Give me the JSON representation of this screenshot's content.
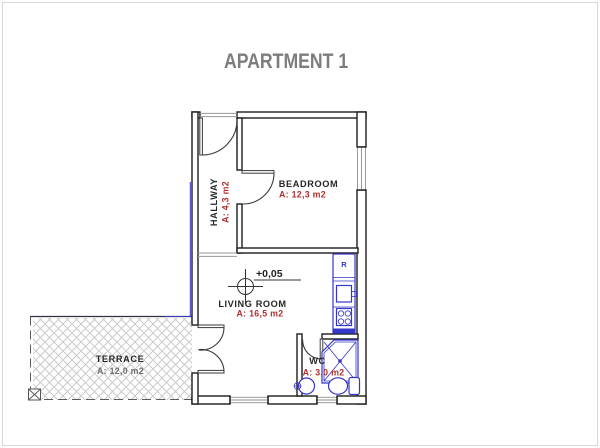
{
  "title": "APARTMENT 1",
  "plan": {
    "rooms": [
      {
        "name": "HALLWAY",
        "area": "A: 4,3 m2"
      },
      {
        "name": "BEADROOM",
        "area": "A: 12,3 m2"
      },
      {
        "name": "LIVING ROOM",
        "area": "A: 16,5 m2"
      },
      {
        "name": "WC",
        "area": "A: 3,0 m2"
      },
      {
        "name": "TERRACE",
        "area": "A: 12,0 m2"
      }
    ],
    "level_marker": "+0,05",
    "kitchen": {
      "fridge_label": "R"
    }
  },
  "colors": {
    "wall": "#1d1d1d",
    "door": "#3a3a3a",
    "fixture_blue": "#3636c9",
    "area_red": "#b03030",
    "room_text": "#262626",
    "terrace_area_text": "#6e6e6e",
    "title_gray": "#7d7d7d",
    "hatch_gray": "#cbcbcb",
    "thin_gray": "#989898",
    "frame_gray": "#d9d9d9"
  }
}
